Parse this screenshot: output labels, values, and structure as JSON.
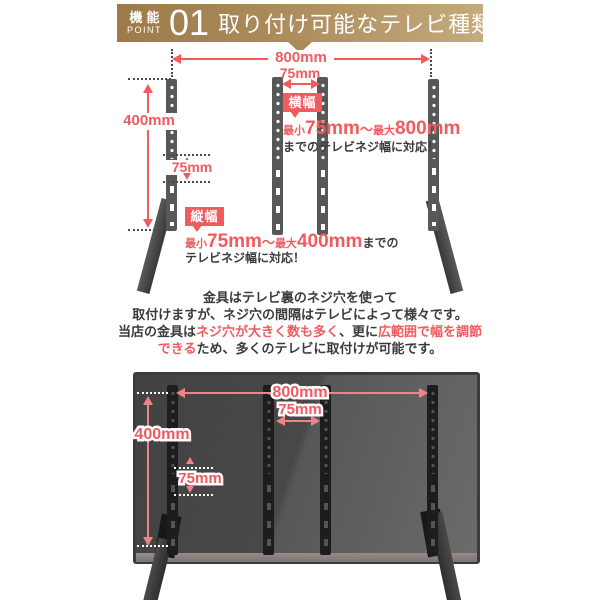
{
  "header": {
    "feature_kanji": "機能",
    "feature_en": "POINT",
    "number": "01",
    "title": "取り付け可能なテレビ種類が多い"
  },
  "top_diagram": {
    "dim_width": "800mm",
    "dim_width_inner": "75mm",
    "dim_height": "400mm",
    "dim_height_inner": "75mm",
    "width_spec": {
      "badge": "横幅",
      "min_label": "最小",
      "min_value": "75mm",
      "tilde": "〜",
      "max_label": "最大",
      "max_value": "800mm",
      "note": "までのテレビネジ幅に対応！"
    },
    "height_spec": {
      "badge": "縦幅",
      "min_label": "最小",
      "min_value": "75mm",
      "tilde": "〜",
      "max_label": "最大",
      "max_value": "400mm",
      "note_inline": "までの",
      "note_line2": "テレビネジ幅に対応！"
    }
  },
  "description": {
    "line1": "金具はテレビ裏のネジ穴を使って",
    "line2": "取付けますが、ネジ穴の間隔はテレビによって様々です。",
    "line3_black1": "当店の金具は",
    "line3_red1": "ネジ穴が大きく数も多く",
    "line3_black2": "、更に",
    "line3_red2": "広範囲で幅を調節",
    "line4_red": "できる",
    "line4_black": "ため、多くのテレビに取付けが可能です。"
  },
  "bottom_figure": {
    "dim_width": "800mm",
    "dim_width_inner": "75mm",
    "dim_height": "400mm",
    "dim_height_inner": "75mm"
  },
  "colors": {
    "accent_red": "#f15b5e",
    "badge_red": "#ee5c60",
    "gold_dark": "#9c7a49",
    "gold_light": "#c4aa7d",
    "arrow_pink": "#ef8487",
    "panel_gray": "#4a4a4a",
    "bracket_black": "#1d1d1d"
  }
}
